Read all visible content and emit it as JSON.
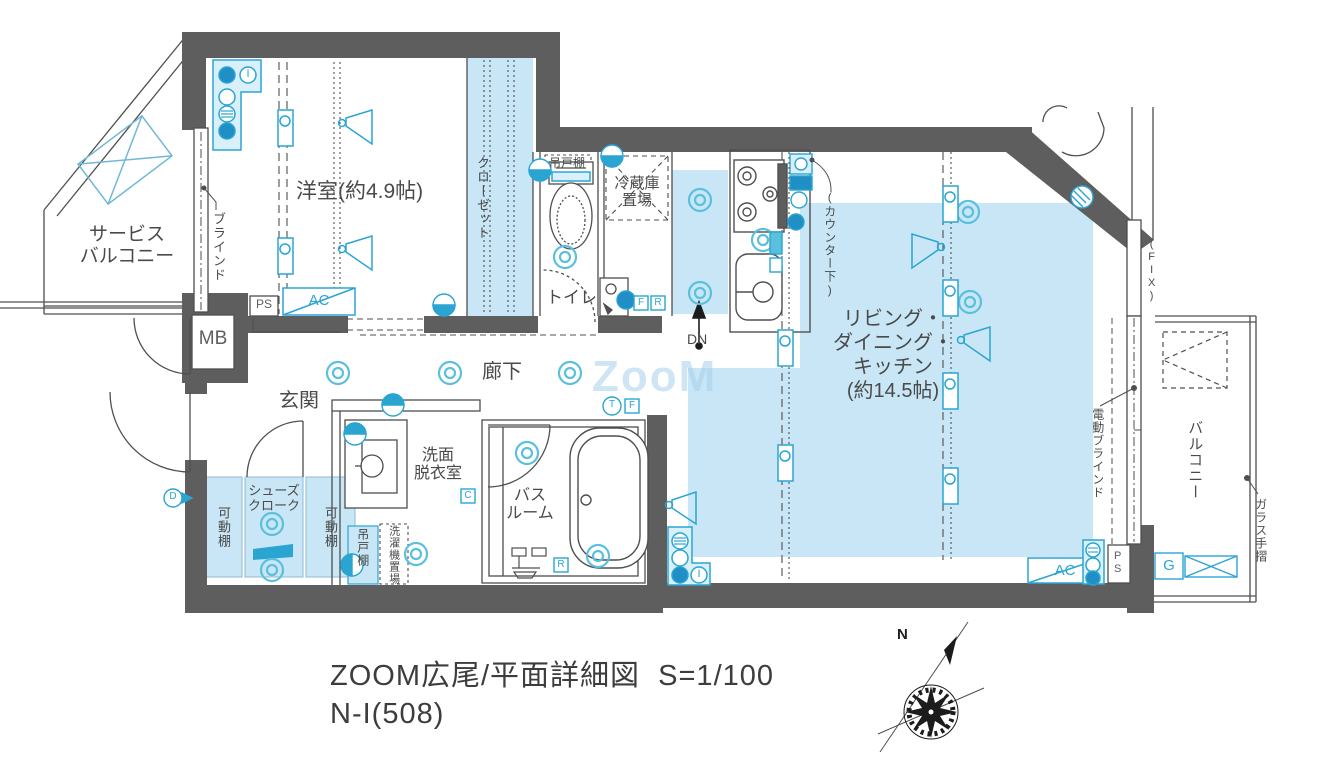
{
  "meta": {
    "title_line1": "ZOOM広尾/平面詳細図  S=1/100",
    "title_line2": "N-I(508)",
    "watermark": "ZooM",
    "north": "N"
  },
  "rooms": {
    "western_room": "洋室(約4.9帖)",
    "closet": "クローゼット",
    "service_balcony": "サービス\nバルコニー",
    "toilet": "トイレ",
    "corridor": "廊下",
    "entrance": "玄関",
    "washroom": "洗面\n脱衣室",
    "bathroom": "バス\nルーム",
    "shoes_closet": "シューズ\nクローク",
    "ldk": "リビング・\nダイニング・\nキッチン\n(約14.5帖)",
    "balcony": "バルコニー"
  },
  "labels": {
    "blind": "ブラインド",
    "electric_blind": "電動ブラインド",
    "glass_handrail": "ガラス手摺",
    "fix_window": "(FIX)",
    "counter_under": "(カウンター下)",
    "refrigerator": "冷蔵庫\n置場",
    "hanging_cupboard_toilet": "吊戸棚",
    "hanging_cupboard_bottom": "吊戸棚",
    "washer_space": "洗濯機置場",
    "movable_shelf_left": "可動棚",
    "movable_shelf_right": "可動棚",
    "mb": "MB",
    "ps_top": "PS",
    "ps_corner": "PS",
    "ps_bottom": "PS",
    "ac_top": "AC",
    "ac_bottom": "AC",
    "dn": "DN"
  },
  "icon_letters": {
    "i_top": "I",
    "i_bottom": "I",
    "f_toilet": "F",
    "r_toilet": "R",
    "t_corridor": "T",
    "f_corridor": "F",
    "c_bath": "C",
    "r_bath": "R",
    "d_left": "D",
    "g_right": "G"
  },
  "colors": {
    "wall": "#5e5e5e",
    "line": "#4f4f4f",
    "highlight": "#c8e6f5",
    "accent": "#2aa5d2",
    "text": "#4a4a4a"
  }
}
